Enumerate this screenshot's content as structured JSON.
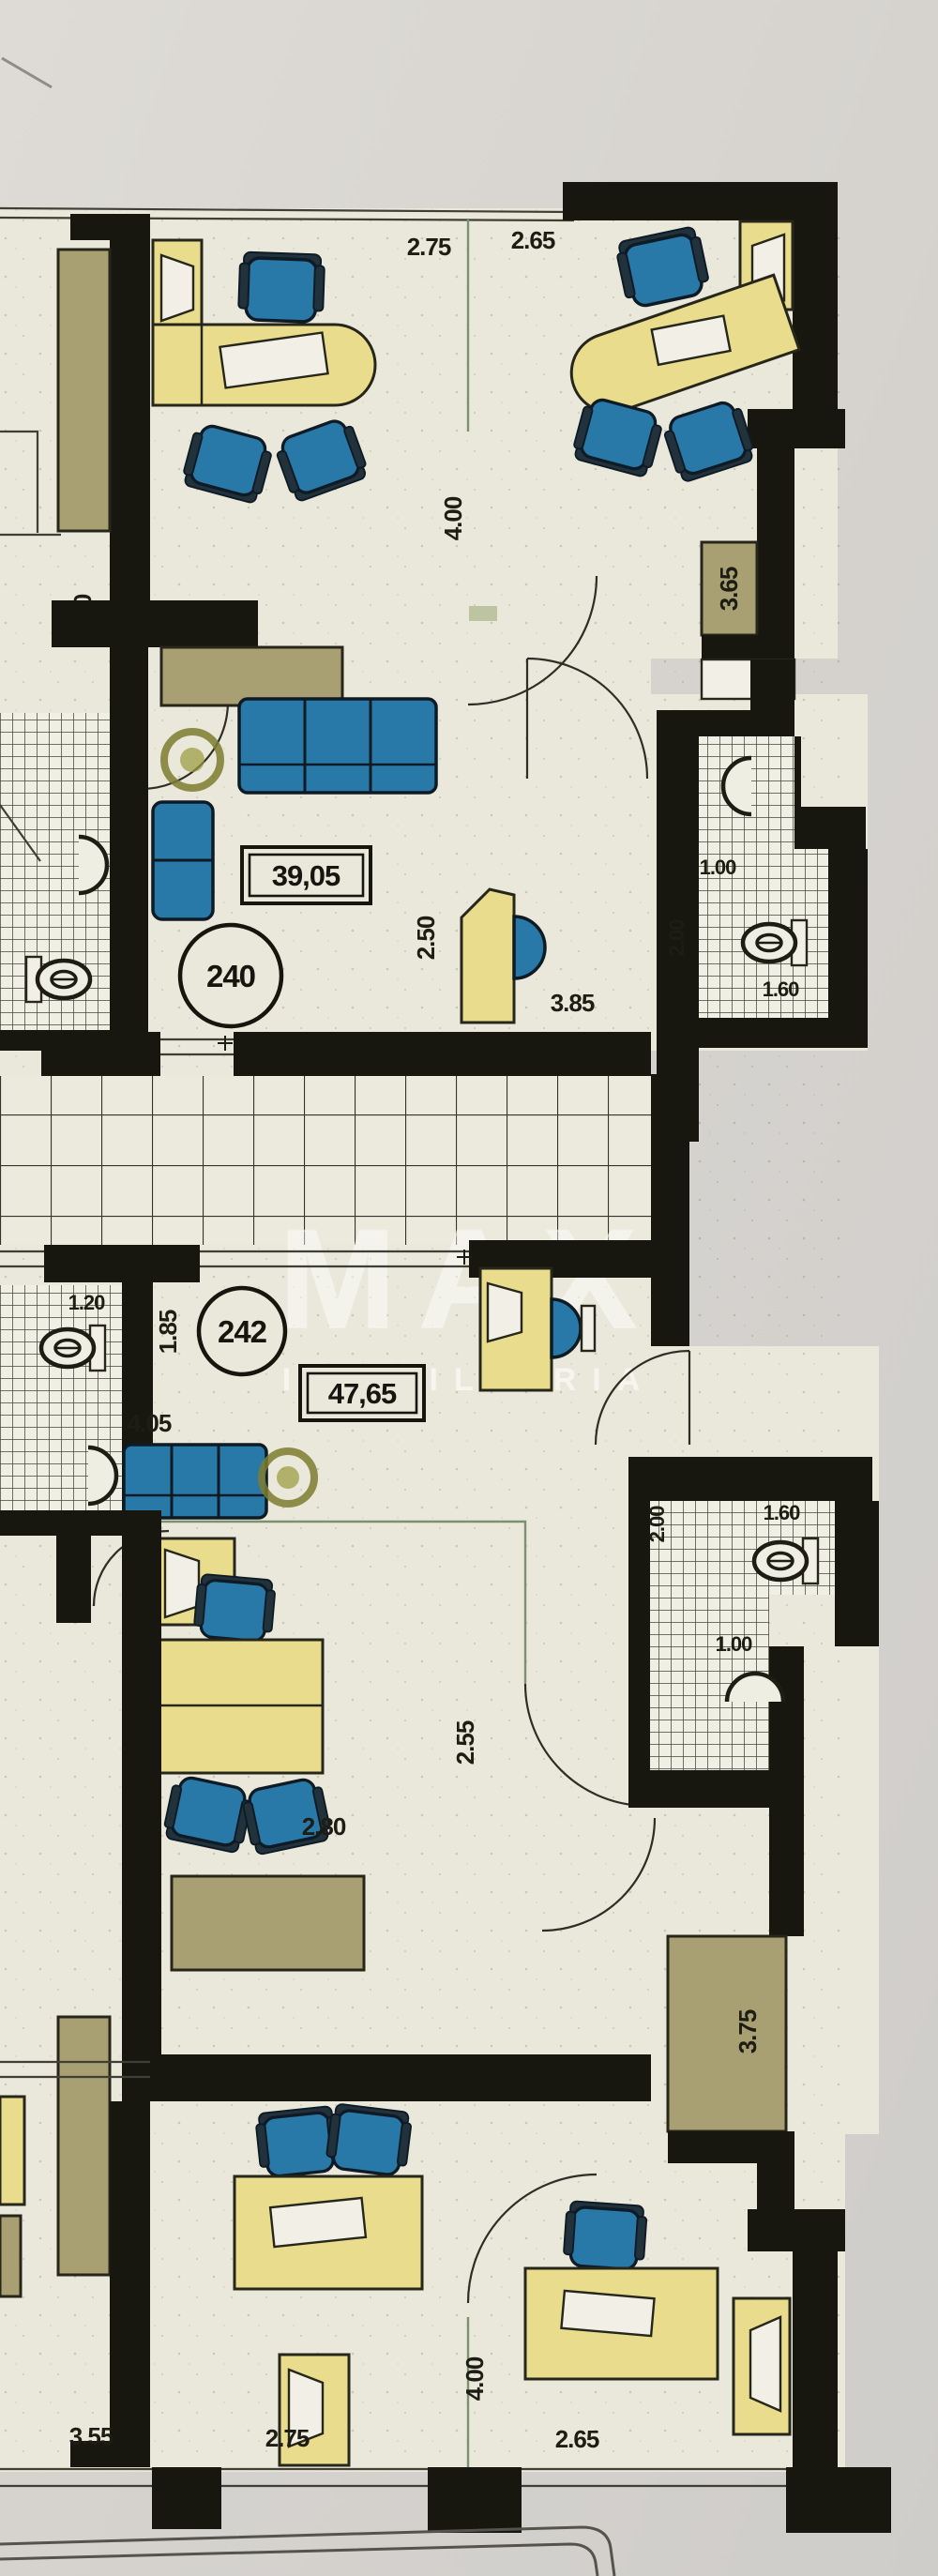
{
  "title": "Floor plan sheet",
  "watermark": {
    "line1": "MAX",
    "line2": "IMOBILIÁRIA"
  },
  "colors": {
    "paper": "#d8d5d0",
    "floor": "#eae8db",
    "wall": "#17170f",
    "furniture_yellow": "#e9dd8d",
    "furniture_blue": "#2878a8",
    "cabinet_tan": "#a89f72",
    "plant_olive": "#7c7c2f",
    "partition_green": "#7d9070"
  },
  "top_offices": {
    "dim_width_left": "2.75",
    "dim_width_right": "2.65",
    "dim_depth": "4.00",
    "dim_side_left": "3.50",
    "dim_closet": "3.65"
  },
  "unit_240": {
    "number": "240",
    "area": "39,05",
    "dim_entry_width": "2.50",
    "dim_entry_length": "3.85",
    "dim_bath_width": "1.00",
    "dim_bath_length": "1.60",
    "dim_bath_depth": "2.00"
  },
  "unit_242": {
    "number": "242",
    "area": "47,65",
    "dim_bath_left_width": "1.20",
    "dim_hall": "1.85",
    "dim_living_width": "4.05",
    "dim_inner": "2.55",
    "dim_bath_depth": "2.00",
    "dim_bath_length": "1.60",
    "dim_bath_width": "1.00",
    "dim_lower": "2.80",
    "dim_closet": "3.75"
  },
  "bottom_offices": {
    "dim_side_left": "3.55",
    "dim_width_left": "2.75",
    "dim_depth": "4.00",
    "dim_width_right": "2.65"
  }
}
